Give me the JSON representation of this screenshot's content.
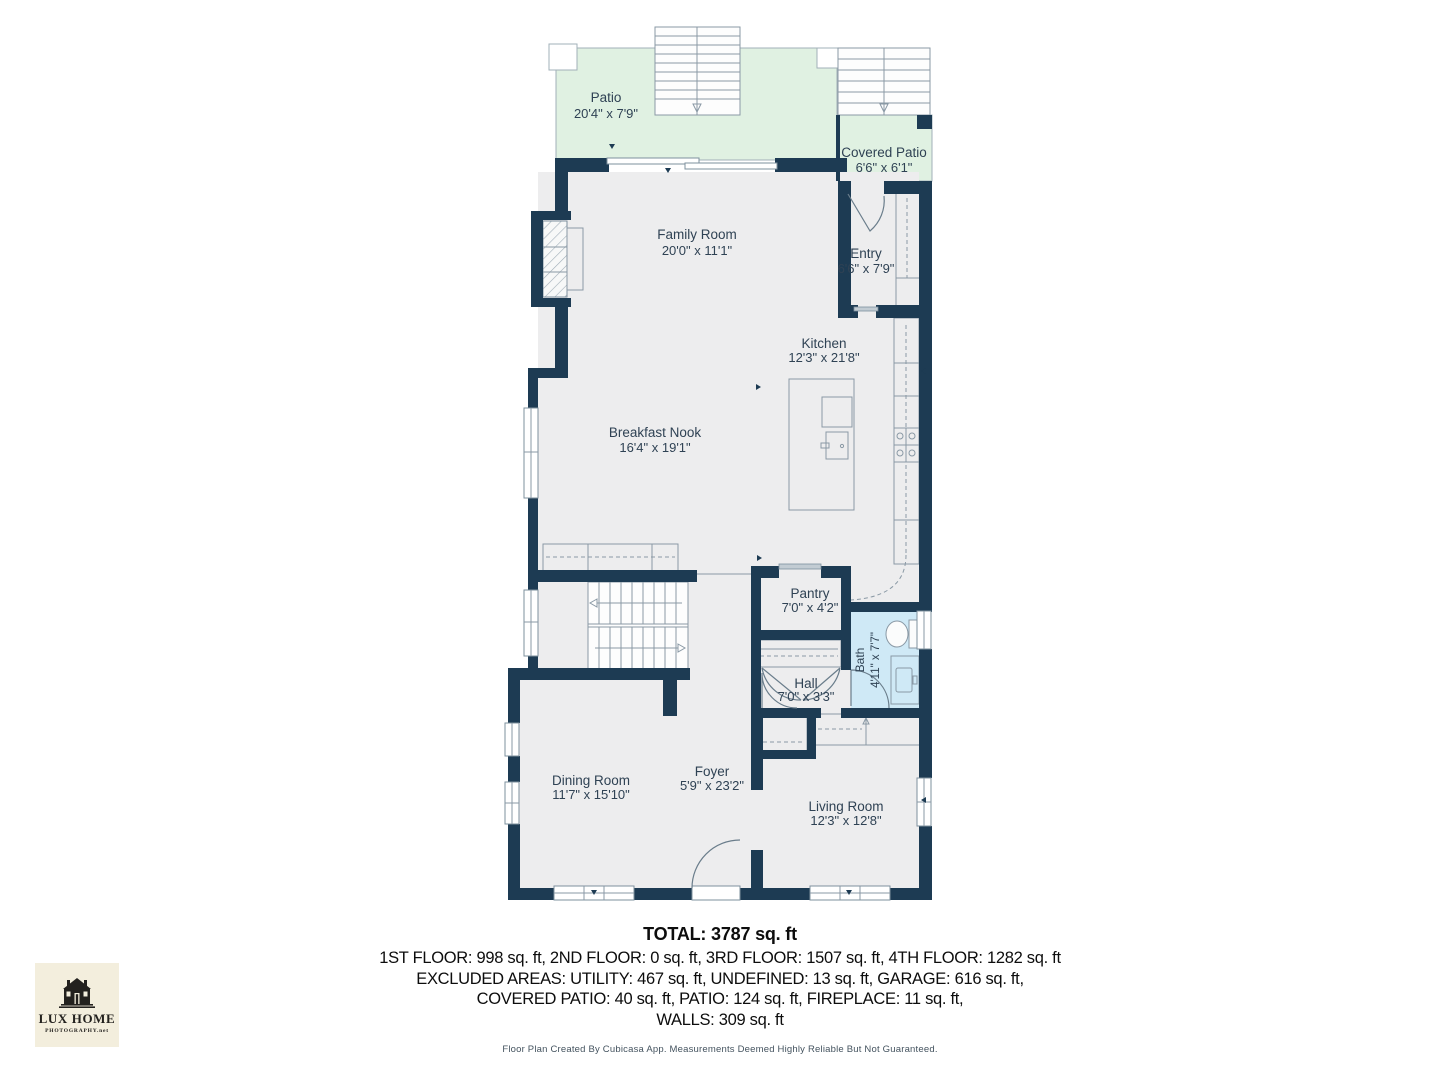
{
  "colors": {
    "wall": "#1d3b53",
    "floor": "#ededee",
    "patio": "#e0f1e2",
    "bath": "#cfe9f6",
    "label": "#2f4254"
  },
  "rooms": [
    {
      "name": "Patio",
      "dims": "20'4\" x 7'9\""
    },
    {
      "name": "Covered Patio",
      "dims": "6'6\" x 6'1\""
    },
    {
      "name": "Family Room",
      "dims": "20'0\" x 11'1\""
    },
    {
      "name": "Entry",
      "dims": "6'6\" x 7'9\""
    },
    {
      "name": "Kitchen",
      "dims": "12'3\" x 21'8\""
    },
    {
      "name": "Breakfast Nook",
      "dims": "16'4\" x 19'1\""
    },
    {
      "name": "Pantry",
      "dims": "7'0\" x 4'2\""
    },
    {
      "name": "Bath",
      "dims": "4'11\" x 7'7\""
    },
    {
      "name": "Hall",
      "dims": "7'0\" x 3'3\""
    },
    {
      "name": "Dining Room",
      "dims": "11'7\" x 15'10\""
    },
    {
      "name": "Foyer",
      "dims": "5'9\" x 23'2\""
    },
    {
      "name": "Living Room",
      "dims": "12'3\" x 12'8\""
    }
  ],
  "summary": {
    "total": "TOTAL: 3787 sq. ft",
    "line1": "1ST FLOOR: 998 sq. ft, 2ND FLOOR: 0 sq. ft, 3RD FLOOR: 1507 sq. ft, 4TH FLOOR: 1282 sq. ft",
    "line2": "EXCLUDED AREAS: UTILITY: 467 sq. ft, UNDEFINED: 13 sq. ft, GARAGE: 616 sq. ft,",
    "line3": "COVERED PATIO: 40 sq. ft, PATIO: 124 sq. ft, FIREPLACE: 11 sq. ft,",
    "line4": "WALLS: 309 sq. ft"
  },
  "footer": "Floor Plan Created By Cubicasa App. Measurements Deemed Highly Reliable But Not Guaranteed.",
  "logo": {
    "title": "LUX HOME",
    "subtitle": "PHOTOGRAPHY.net"
  }
}
